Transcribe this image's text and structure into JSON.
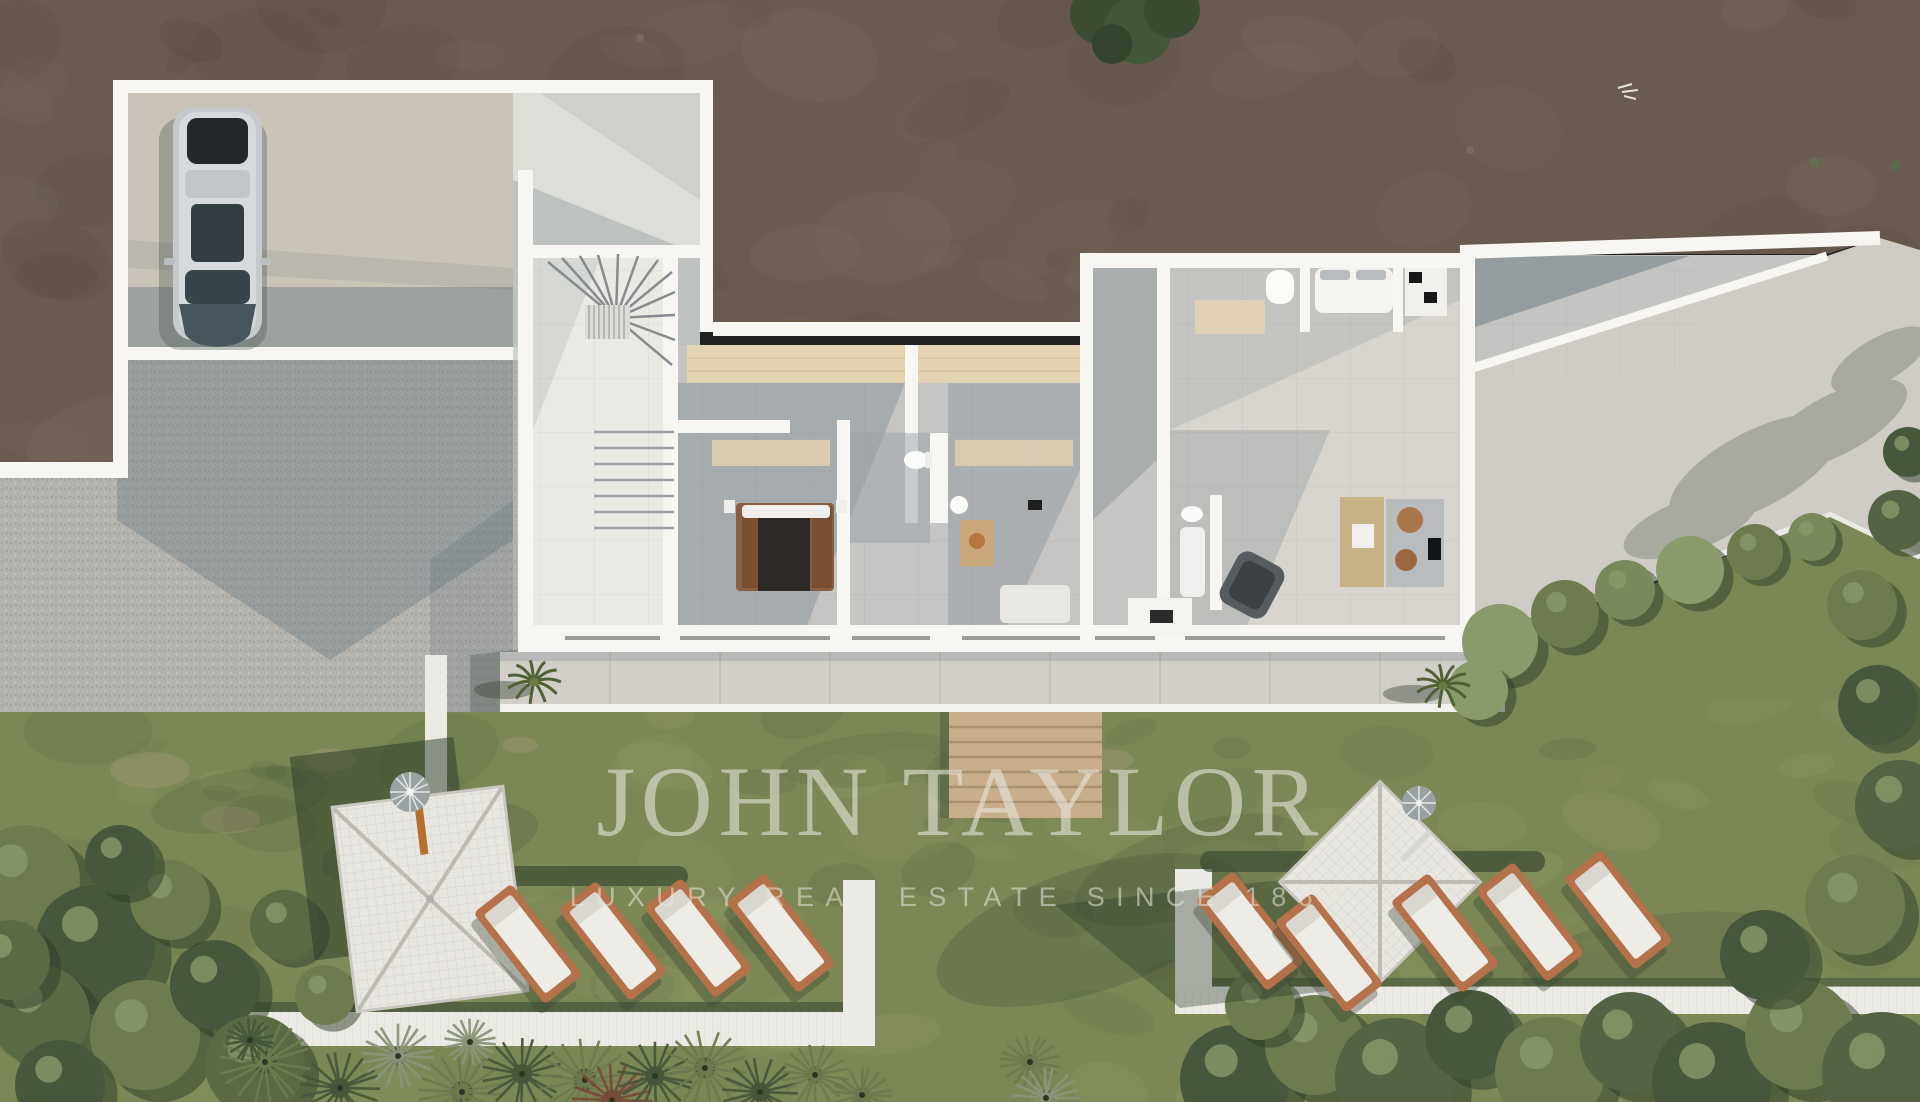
{
  "watermark": {
    "title": "JOHN TAYLOR",
    "subtitle": "LUXURY REAL ESTATE SINCE 1864"
  },
  "palette": {
    "dirt": "#6a5b50",
    "dirt_dark": "#56493f",
    "dirt_light": "#7e6e61",
    "gravel": "#b5b3ae",
    "shadow_blue": "#5d6f7a",
    "pad_concrete": "#c9c3b8",
    "apron": "#deded8",
    "wall_white": "#f7f6f3",
    "tile_light": "#ebe9e4",
    "tile_gray": "#c6c5c3",
    "tile_warm": "#d8d5cf",
    "travertine": "#e4d3b2",
    "terrace": "#d2cfc9",
    "plane_concrete": "#cfccc5",
    "wood_steps": "#c9ae8c",
    "grass": "#7b8755",
    "grass_light": "#97a26a",
    "grass_dark": "#55643f",
    "olive": "#6e7b4f",
    "tree_dark": "#47573b",
    "lounger_wood": "#b4714a",
    "cushion": "#edece6",
    "canopy": "#e9e7e1",
    "path": "#eceae5",
    "car_body": "#c6cacc",
    "car_glass": "#333d42",
    "car_hood": "#46565c",
    "bed_wood": "#8a5f41",
    "bed_blanket": "#2c2927",
    "rattan": "#a8764a",
    "watermark": "#eae9e0"
  },
  "scene": {
    "type": "aerial-architectural-render",
    "description": "Top-down render of a modern single-storey villa: garage court with parked car, gravel drive, fan staircase, bedroom suites with baths, living room, south terrace with palms, wooden garden steps, lawn with two pergolas, rows of sun loungers, white garden paths and mediterranean planting"
  }
}
